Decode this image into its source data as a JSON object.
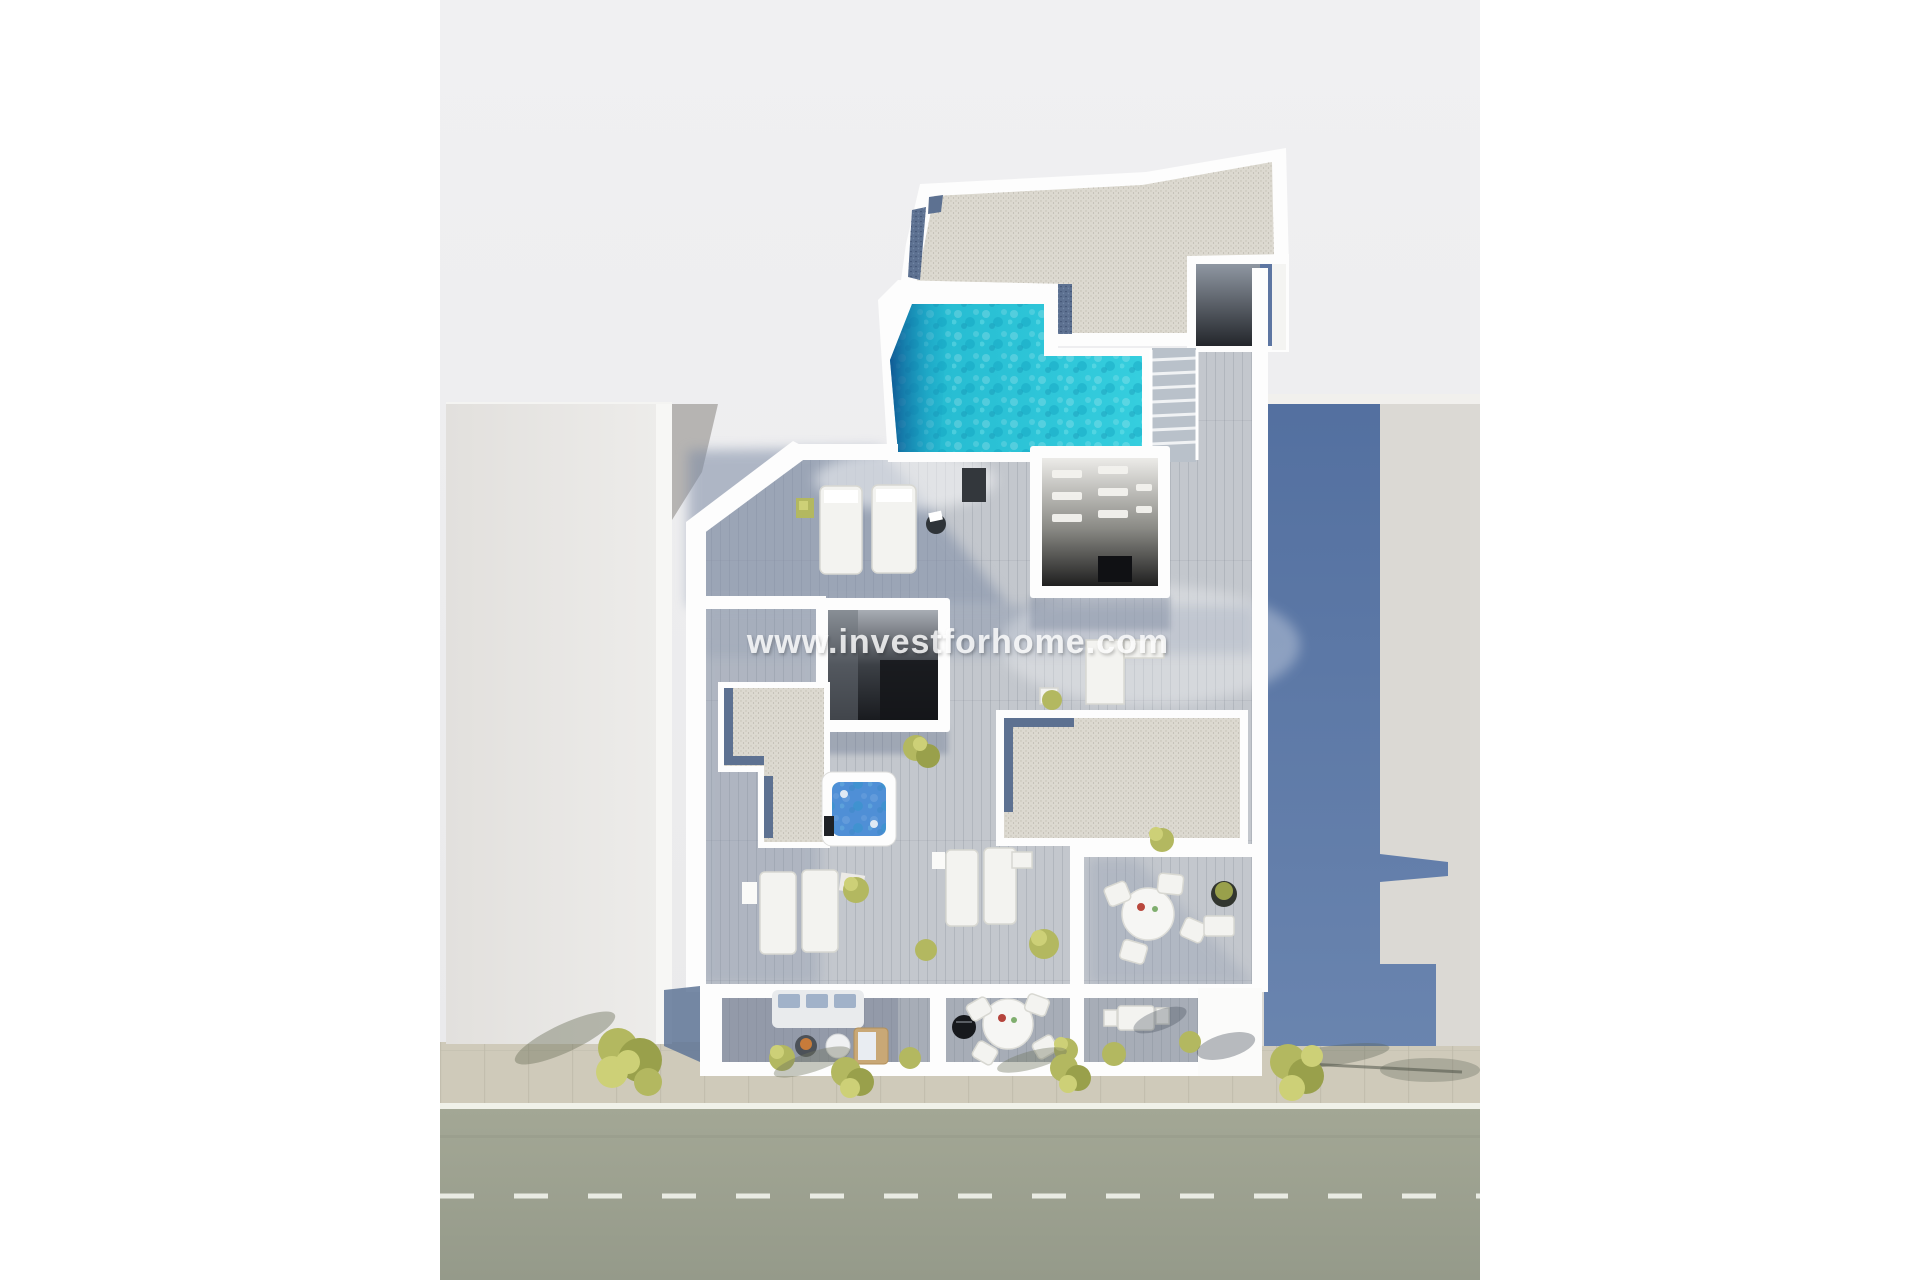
{
  "watermark": {
    "text": "www.investforhome.com"
  },
  "scene": {
    "type": "aerial-3d-floorplan-render",
    "elements": [
      "background",
      "street-road",
      "road-center-line",
      "road-edge-line",
      "sidewalk",
      "street-trees",
      "left-neighbor-building",
      "right-neighbor-building",
      "building-cast-shadow",
      "alley-strip",
      "main-building",
      "gravel-roof",
      "skylight-strips",
      "rooftop-pool",
      "pool-deep-end",
      "pool-stairs",
      "stair-bulkhead",
      "wood-deck-terrace",
      "stairwell-opening",
      "pergola-room",
      "gravel-patio-left",
      "gravel-patio-right",
      "jacuzzi",
      "sun-loungers",
      "dining-table-round",
      "outdoor-chairs",
      "sofa",
      "wooden-daybed",
      "grill",
      "planters",
      "lower-terraces",
      "terrace-dividers",
      "glass-balustrade",
      "watermark-text"
    ]
  },
  "palette": {
    "bg": "#ececee",
    "road": "#9ba092",
    "roadLine": "#f0f1e9",
    "sidewalk": "#cfcaba",
    "paverLine": "#b4af9f",
    "gravel": "#dcd9d0",
    "chips": "#5d7191",
    "deck": "#c3c7cd",
    "deckShadow": "#7b8aa4",
    "lowerDeck": "#a7adb7",
    "poolWater": "#2cc5d8",
    "poolDeep": "#0e4f8e",
    "jacuzziWater": "#4f8fd6",
    "leftBuilding": "#e7e5e2",
    "rightBuilding": "#dbd9d4",
    "castShadow": "#4a699d",
    "castShadow2": "#627fae",
    "treeLight": "#cdd077",
    "treeMid": "#b3b860",
    "treeDark": "#99a04b",
    "wallWhite": "#fdfdfd",
    "facetGray": "#b6b4b2",
    "alley": "#c2c4c6",
    "roomDark": "#1d1f24"
  }
}
